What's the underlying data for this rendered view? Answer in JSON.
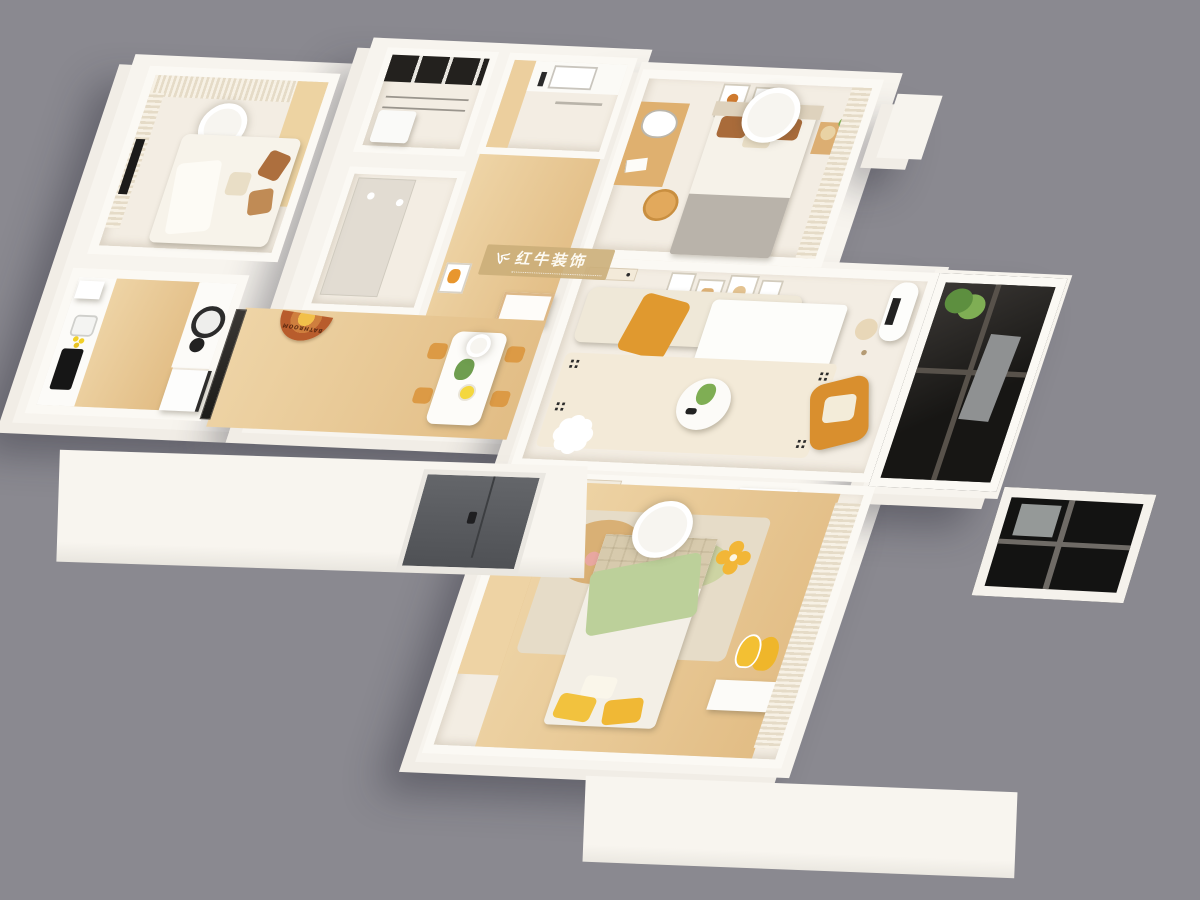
{
  "palette": {
    "bg": "#8a8990",
    "wall": "#f7f4ee",
    "wall-edge": "#f1ede6",
    "floor": "#f3ede3",
    "wood": "#eed4a6",
    "wood-dark": "#e2bd85",
    "mustard": "#e0992f",
    "cream": "#efe8d8",
    "brown": "#a96b3a",
    "green-blanket": "#bcd09a",
    "glass": "#1b1a18",
    "mat": "#b85c2c"
  },
  "watermark": {
    "title": "红牛装饰",
    "logo": "bull-logo"
  },
  "labels": {
    "bath_mat": "BATHROOM"
  }
}
